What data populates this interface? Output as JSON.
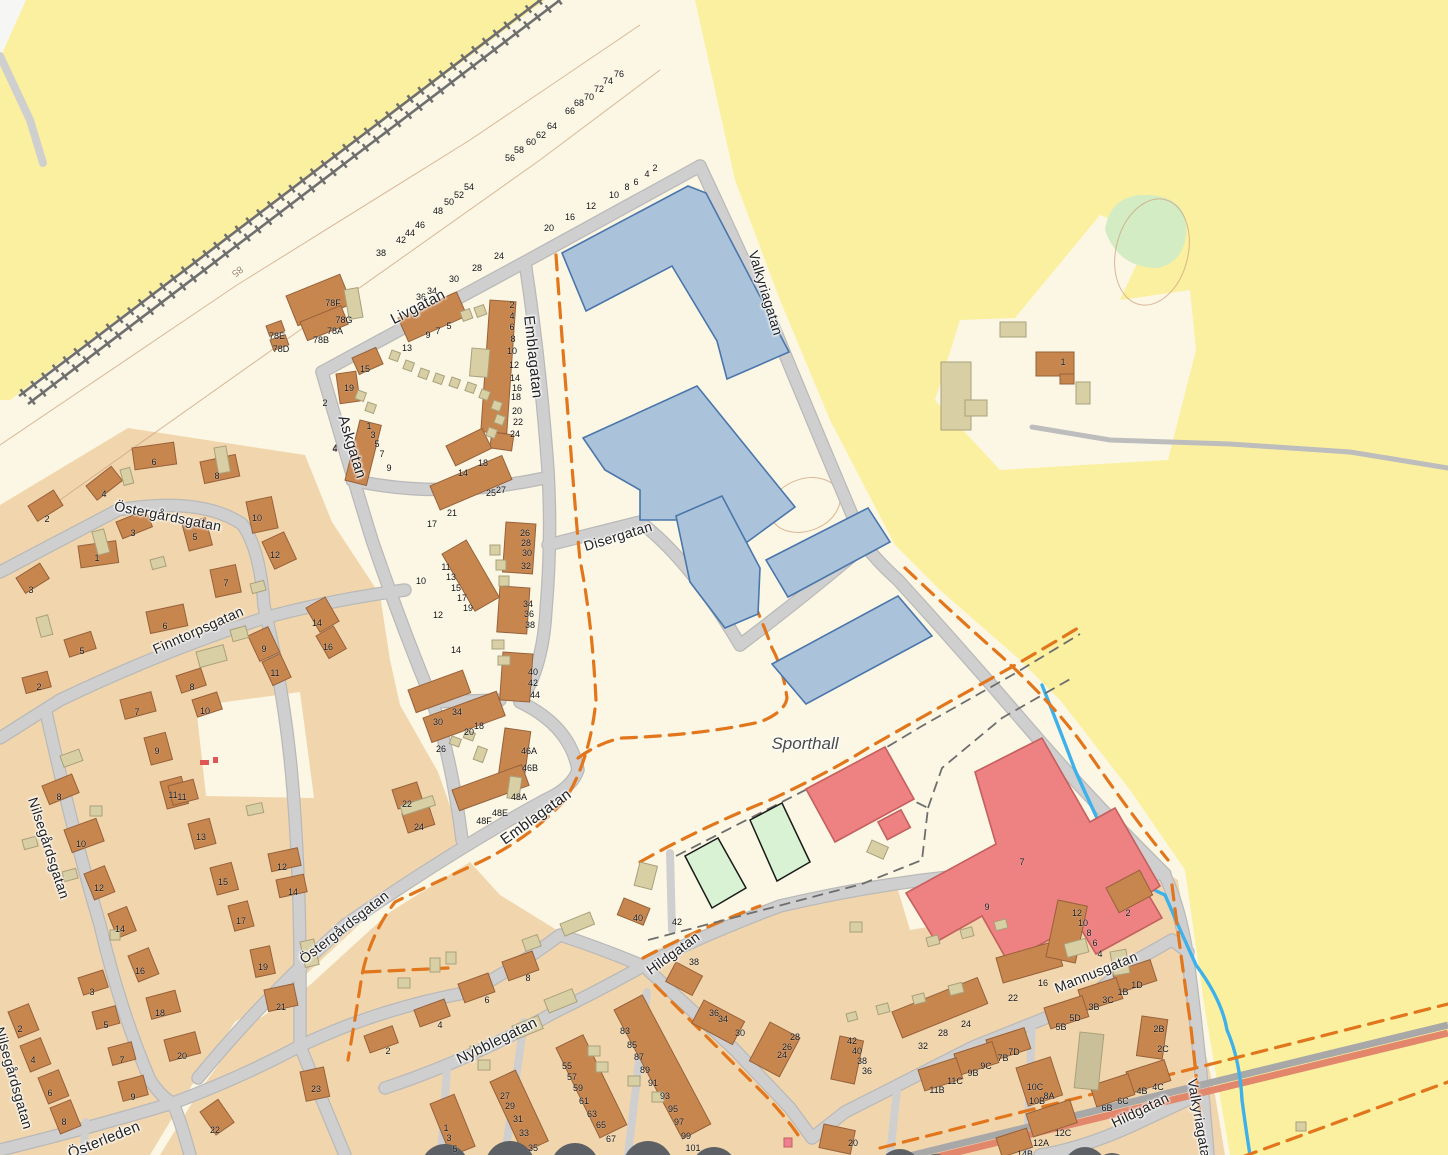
{
  "map": {
    "title": "Sporthall district map",
    "colors": {
      "farmland": "#fbf0a0",
      "land": "#fbf7e4",
      "residential": "#f1d6ad",
      "building_brown": "#c8864f",
      "building_beige": "#d8cfa5",
      "building_blue": "#aac3da",
      "building_red": "#ee8181",
      "sports_court": "#d8f2d3",
      "road": "#cfcfcf",
      "path_dashed": "#e2761c",
      "stream": "#3fb1ea",
      "main_road": "#e2876b",
      "railway": "#6f6f6f"
    },
    "street_labels": [
      [
        "Livgatan",
        418,
        307,
        -27,
        15
      ],
      [
        "Emblagatan",
        533,
        357,
        84,
        15
      ],
      [
        "Askgatan",
        352,
        447,
        73,
        15
      ],
      [
        "Östergårdsgatan",
        168,
        516,
        11,
        14
      ],
      [
        "Finntorpsgatan",
        198,
        630,
        -24,
        14
      ],
      [
        "Nilsegårdsgatan",
        49,
        848,
        72,
        14
      ],
      [
        "Östergårdsgatan",
        344,
        927,
        -38,
        14
      ],
      [
        "Emblagatan",
        536,
        817,
        -36,
        15
      ],
      [
        "Disergatan",
        618,
        536,
        -17,
        14
      ],
      [
        "Valkyriagatan",
        766,
        293,
        73,
        14
      ],
      [
        "Österleden",
        104,
        1140,
        -22,
        15
      ],
      [
        "Nilsegårdsgatan",
        14,
        1078,
        74,
        14
      ],
      [
        "Nybblegatan",
        497,
        1041,
        -26,
        15
      ],
      [
        "Hildgatan",
        673,
        953,
        -36,
        14
      ],
      [
        "Mannusgatan",
        1096,
        972,
        -22,
        14
      ],
      [
        "Hildgatan",
        1140,
        1110,
        -26,
        14
      ],
      [
        "Valkyriagatan",
        1200,
        1122,
        80,
        14
      ]
    ],
    "area_labels": [
      [
        "Sporthall",
        805,
        744,
        0,
        17
      ]
    ],
    "contour_labels": [
      [
        "85",
        237,
        271,
        142,
        10
      ]
    ],
    "house_numbers": [
      [
        "2",
        655,
        168
      ],
      [
        "4",
        647,
        174
      ],
      [
        "6",
        636,
        182
      ],
      [
        "8",
        627,
        187
      ],
      [
        "10",
        614,
        195
      ],
      [
        "12",
        591,
        206
      ],
      [
        "16",
        570,
        217
      ],
      [
        "20",
        549,
        228
      ],
      [
        "24",
        499,
        256
      ],
      [
        "28",
        477,
        268
      ],
      [
        "30",
        454,
        279
      ],
      [
        "34",
        432,
        291
      ],
      [
        "36",
        421,
        297
      ],
      [
        "38",
        381,
        253
      ],
      [
        "42",
        401,
        240
      ],
      [
        "44",
        410,
        233
      ],
      [
        "46",
        420,
        225
      ],
      [
        "48",
        438,
        211
      ],
      [
        "50",
        449,
        202
      ],
      [
        "52",
        459,
        195
      ],
      [
        "54",
        469,
        187
      ],
      [
        "56",
        510,
        158
      ],
      [
        "58",
        519,
        150
      ],
      [
        "60",
        531,
        142
      ],
      [
        "62",
        541,
        135
      ],
      [
        "64",
        552,
        126
      ],
      [
        "66",
        570,
        111
      ],
      [
        "68",
        579,
        103
      ],
      [
        "70",
        589,
        97
      ],
      [
        "72",
        599,
        89
      ],
      [
        "74",
        608,
        81
      ],
      [
        "76",
        619,
        74
      ],
      [
        "78F",
        333,
        303
      ],
      [
        "78G",
        344,
        320
      ],
      [
        "78A",
        335,
        331
      ],
      [
        "78B",
        321,
        340
      ],
      [
        "78E",
        277,
        336
      ],
      [
        "78D",
        281,
        349
      ],
      [
        "13",
        407,
        348
      ],
      [
        "9",
        428,
        335
      ],
      [
        "7",
        438,
        331
      ],
      [
        "5",
        449,
        326
      ],
      [
        "15",
        365,
        369
      ],
      [
        "19",
        349,
        388
      ],
      [
        "2",
        325,
        403
      ],
      [
        "4",
        335,
        449
      ],
      [
        "6",
        359,
        468
      ],
      [
        "1",
        369,
        426
      ],
      [
        "3",
        373,
        435
      ],
      [
        "5",
        377,
        444
      ],
      [
        "7",
        382,
        454
      ],
      [
        "9",
        389,
        468
      ],
      [
        "2",
        512,
        305
      ],
      [
        "4",
        512,
        316
      ],
      [
        "6",
        512,
        327
      ],
      [
        "8",
        513,
        339
      ],
      [
        "10",
        512,
        351
      ],
      [
        "12",
        514,
        365
      ],
      [
        "14",
        515,
        378
      ],
      [
        "16",
        517,
        388
      ],
      [
        "18",
        516,
        397
      ],
      [
        "20",
        517,
        411
      ],
      [
        "22",
        518,
        422
      ],
      [
        "24",
        515,
        434
      ],
      [
        "14",
        463,
        473
      ],
      [
        "18",
        483,
        463
      ],
      [
        "25",
        491,
        493
      ],
      [
        "27",
        501,
        490
      ],
      [
        "17",
        432,
        524
      ],
      [
        "21",
        452,
        513
      ],
      [
        "26",
        525,
        533
      ],
      [
        "28",
        526,
        543
      ],
      [
        "30",
        527,
        553
      ],
      [
        "32",
        526,
        566
      ],
      [
        "11",
        446,
        567
      ],
      [
        "13",
        451,
        577
      ],
      [
        "15",
        456,
        588
      ],
      [
        "17",
        462,
        598
      ],
      [
        "19",
        468,
        608
      ],
      [
        "10",
        421,
        581
      ],
      [
        "12",
        438,
        615
      ],
      [
        "14",
        456,
        650
      ],
      [
        "34",
        528,
        604
      ],
      [
        "36",
        529,
        614
      ],
      [
        "38",
        530,
        625
      ],
      [
        "40",
        533,
        672
      ],
      [
        "42",
        533,
        683
      ],
      [
        "44",
        535,
        695
      ],
      [
        "30",
        438,
        722
      ],
      [
        "34",
        457,
        712
      ],
      [
        "20",
        469,
        732
      ],
      [
        "18",
        479,
        726
      ],
      [
        "26",
        441,
        749
      ],
      [
        "46A",
        529,
        751
      ],
      [
        "46B",
        530,
        768
      ],
      [
        "48A",
        519,
        797
      ],
      [
        "48E",
        500,
        813
      ],
      [
        "48F",
        484,
        821
      ],
      [
        "22",
        407,
        804
      ],
      [
        "24",
        419,
        827
      ],
      [
        "6",
        154,
        462
      ],
      [
        "8",
        217,
        476
      ],
      [
        "4",
        104,
        494
      ],
      [
        "2",
        47,
        519
      ],
      [
        "10",
        257,
        518
      ],
      [
        "3",
        133,
        533
      ],
      [
        "5",
        195,
        537
      ],
      [
        "12",
        275,
        555
      ],
      [
        "1",
        97,
        558
      ],
      [
        "7",
        226,
        583
      ],
      [
        "3",
        31,
        590
      ],
      [
        "6",
        165,
        626
      ],
      [
        "14",
        317,
        623
      ],
      [
        "16",
        328,
        647
      ],
      [
        "9",
        264,
        649
      ],
      [
        "5",
        82,
        651
      ],
      [
        "11",
        275,
        673
      ],
      [
        "2",
        39,
        687
      ],
      [
        "8",
        192,
        687
      ],
      [
        "10",
        205,
        711
      ],
      [
        "7",
        137,
        712
      ],
      [
        "9",
        157,
        751
      ],
      [
        "11",
        173,
        795
      ],
      [
        "4",
        335,
        448
      ],
      [
        "8",
        59,
        797
      ],
      [
        "11",
        182,
        797
      ],
      [
        "10",
        81,
        844
      ],
      [
        "13",
        201,
        837
      ],
      [
        "12",
        99,
        888
      ],
      [
        "15",
        223,
        882
      ],
      [
        "12",
        282,
        867
      ],
      [
        "14",
        293,
        892
      ],
      [
        "17",
        241,
        921
      ],
      [
        "14",
        120,
        929
      ],
      [
        "16",
        140,
        971
      ],
      [
        "19",
        263,
        967
      ],
      [
        "3",
        92,
        992
      ],
      [
        "21",
        281,
        1007
      ],
      [
        "18",
        160,
        1013
      ],
      [
        "5",
        106,
        1025
      ],
      [
        "2",
        20,
        1029
      ],
      [
        "20",
        182,
        1056
      ],
      [
        "4",
        33,
        1060
      ],
      [
        "7",
        122,
        1060
      ],
      [
        "6",
        50,
        1093
      ],
      [
        "9",
        133,
        1097
      ],
      [
        "23",
        316,
        1089
      ],
      [
        "8",
        64,
        1122
      ],
      [
        "22",
        215,
        1130
      ],
      [
        "8",
        528,
        978
      ],
      [
        "6",
        487,
        1000
      ],
      [
        "4",
        440,
        1025
      ],
      [
        "2",
        388,
        1051
      ],
      [
        "1",
        446,
        1128
      ],
      [
        "3",
        449,
        1138
      ],
      [
        "5",
        455,
        1149
      ],
      [
        "27",
        505,
        1096
      ],
      [
        "29",
        510,
        1106
      ],
      [
        "31",
        518,
        1119
      ],
      [
        "33",
        524,
        1133
      ],
      [
        "35",
        533,
        1148
      ],
      [
        "55",
        567,
        1066
      ],
      [
        "57",
        572,
        1077
      ],
      [
        "59",
        578,
        1088
      ],
      [
        "61",
        584,
        1101
      ],
      [
        "63",
        592,
        1114
      ],
      [
        "65",
        601,
        1125
      ],
      [
        "67",
        611,
        1139
      ],
      [
        "83",
        625,
        1031
      ],
      [
        "85",
        632,
        1045
      ],
      [
        "87",
        639,
        1057
      ],
      [
        "89",
        645,
        1070
      ],
      [
        "91",
        653,
        1083
      ],
      [
        "93",
        665,
        1096
      ],
      [
        "95",
        673,
        1109
      ],
      [
        "97",
        679,
        1122
      ],
      [
        "99",
        686,
        1136
      ],
      [
        "101",
        693,
        1148
      ],
      [
        "40",
        638,
        918
      ],
      [
        "42",
        677,
        922
      ],
      [
        "38",
        694,
        962
      ],
      [
        "7",
        1022,
        862
      ],
      [
        "9",
        987,
        907
      ],
      [
        "1",
        1063,
        362
      ],
      [
        "36",
        714,
        1013
      ],
      [
        "34",
        723,
        1019
      ],
      [
        "30",
        740,
        1033
      ],
      [
        "28",
        795,
        1037
      ],
      [
        "26",
        787,
        1047
      ],
      [
        "24",
        782,
        1055
      ],
      [
        "20",
        853,
        1143
      ],
      [
        "42",
        852,
        1041
      ],
      [
        "40",
        857,
        1051
      ],
      [
        "38",
        862,
        1061
      ],
      [
        "36",
        867,
        1071
      ],
      [
        "32",
        923,
        1046
      ],
      [
        "28",
        943,
        1033
      ],
      [
        "24",
        966,
        1024
      ],
      [
        "22",
        1013,
        998
      ],
      [
        "16",
        1043,
        983
      ],
      [
        "12",
        1077,
        913
      ],
      [
        "10",
        1083,
        923
      ],
      [
        "8",
        1089,
        933
      ],
      [
        "6",
        1095,
        943
      ],
      [
        "4",
        1100,
        954
      ],
      [
        "2",
        1128,
        913
      ],
      [
        "1D",
        1137,
        985
      ],
      [
        "1B",
        1123,
        992
      ],
      [
        "3C",
        1108,
        1000
      ],
      [
        "3B",
        1094,
        1007
      ],
      [
        "5D",
        1075,
        1018
      ],
      [
        "5B",
        1061,
        1027
      ],
      [
        "2B",
        1159,
        1029
      ],
      [
        "2C",
        1163,
        1049
      ],
      [
        "7D",
        1014,
        1052
      ],
      [
        "7B",
        1003,
        1058
      ],
      [
        "9C",
        986,
        1066
      ],
      [
        "9B",
        973,
        1073
      ],
      [
        "11C",
        955,
        1081
      ],
      [
        "11B",
        937,
        1090
      ],
      [
        "10C",
        1035,
        1087
      ],
      [
        "10B",
        1037,
        1101
      ],
      [
        "8A",
        1049,
        1096
      ],
      [
        "4C",
        1158,
        1087
      ],
      [
        "4B",
        1142,
        1091
      ],
      [
        "6C",
        1123,
        1101
      ],
      [
        "6B",
        1107,
        1108
      ],
      [
        "12C",
        1063,
        1133
      ],
      [
        "12A",
        1041,
        1143
      ],
      [
        "14B",
        1025,
        1154
      ]
    ]
  }
}
